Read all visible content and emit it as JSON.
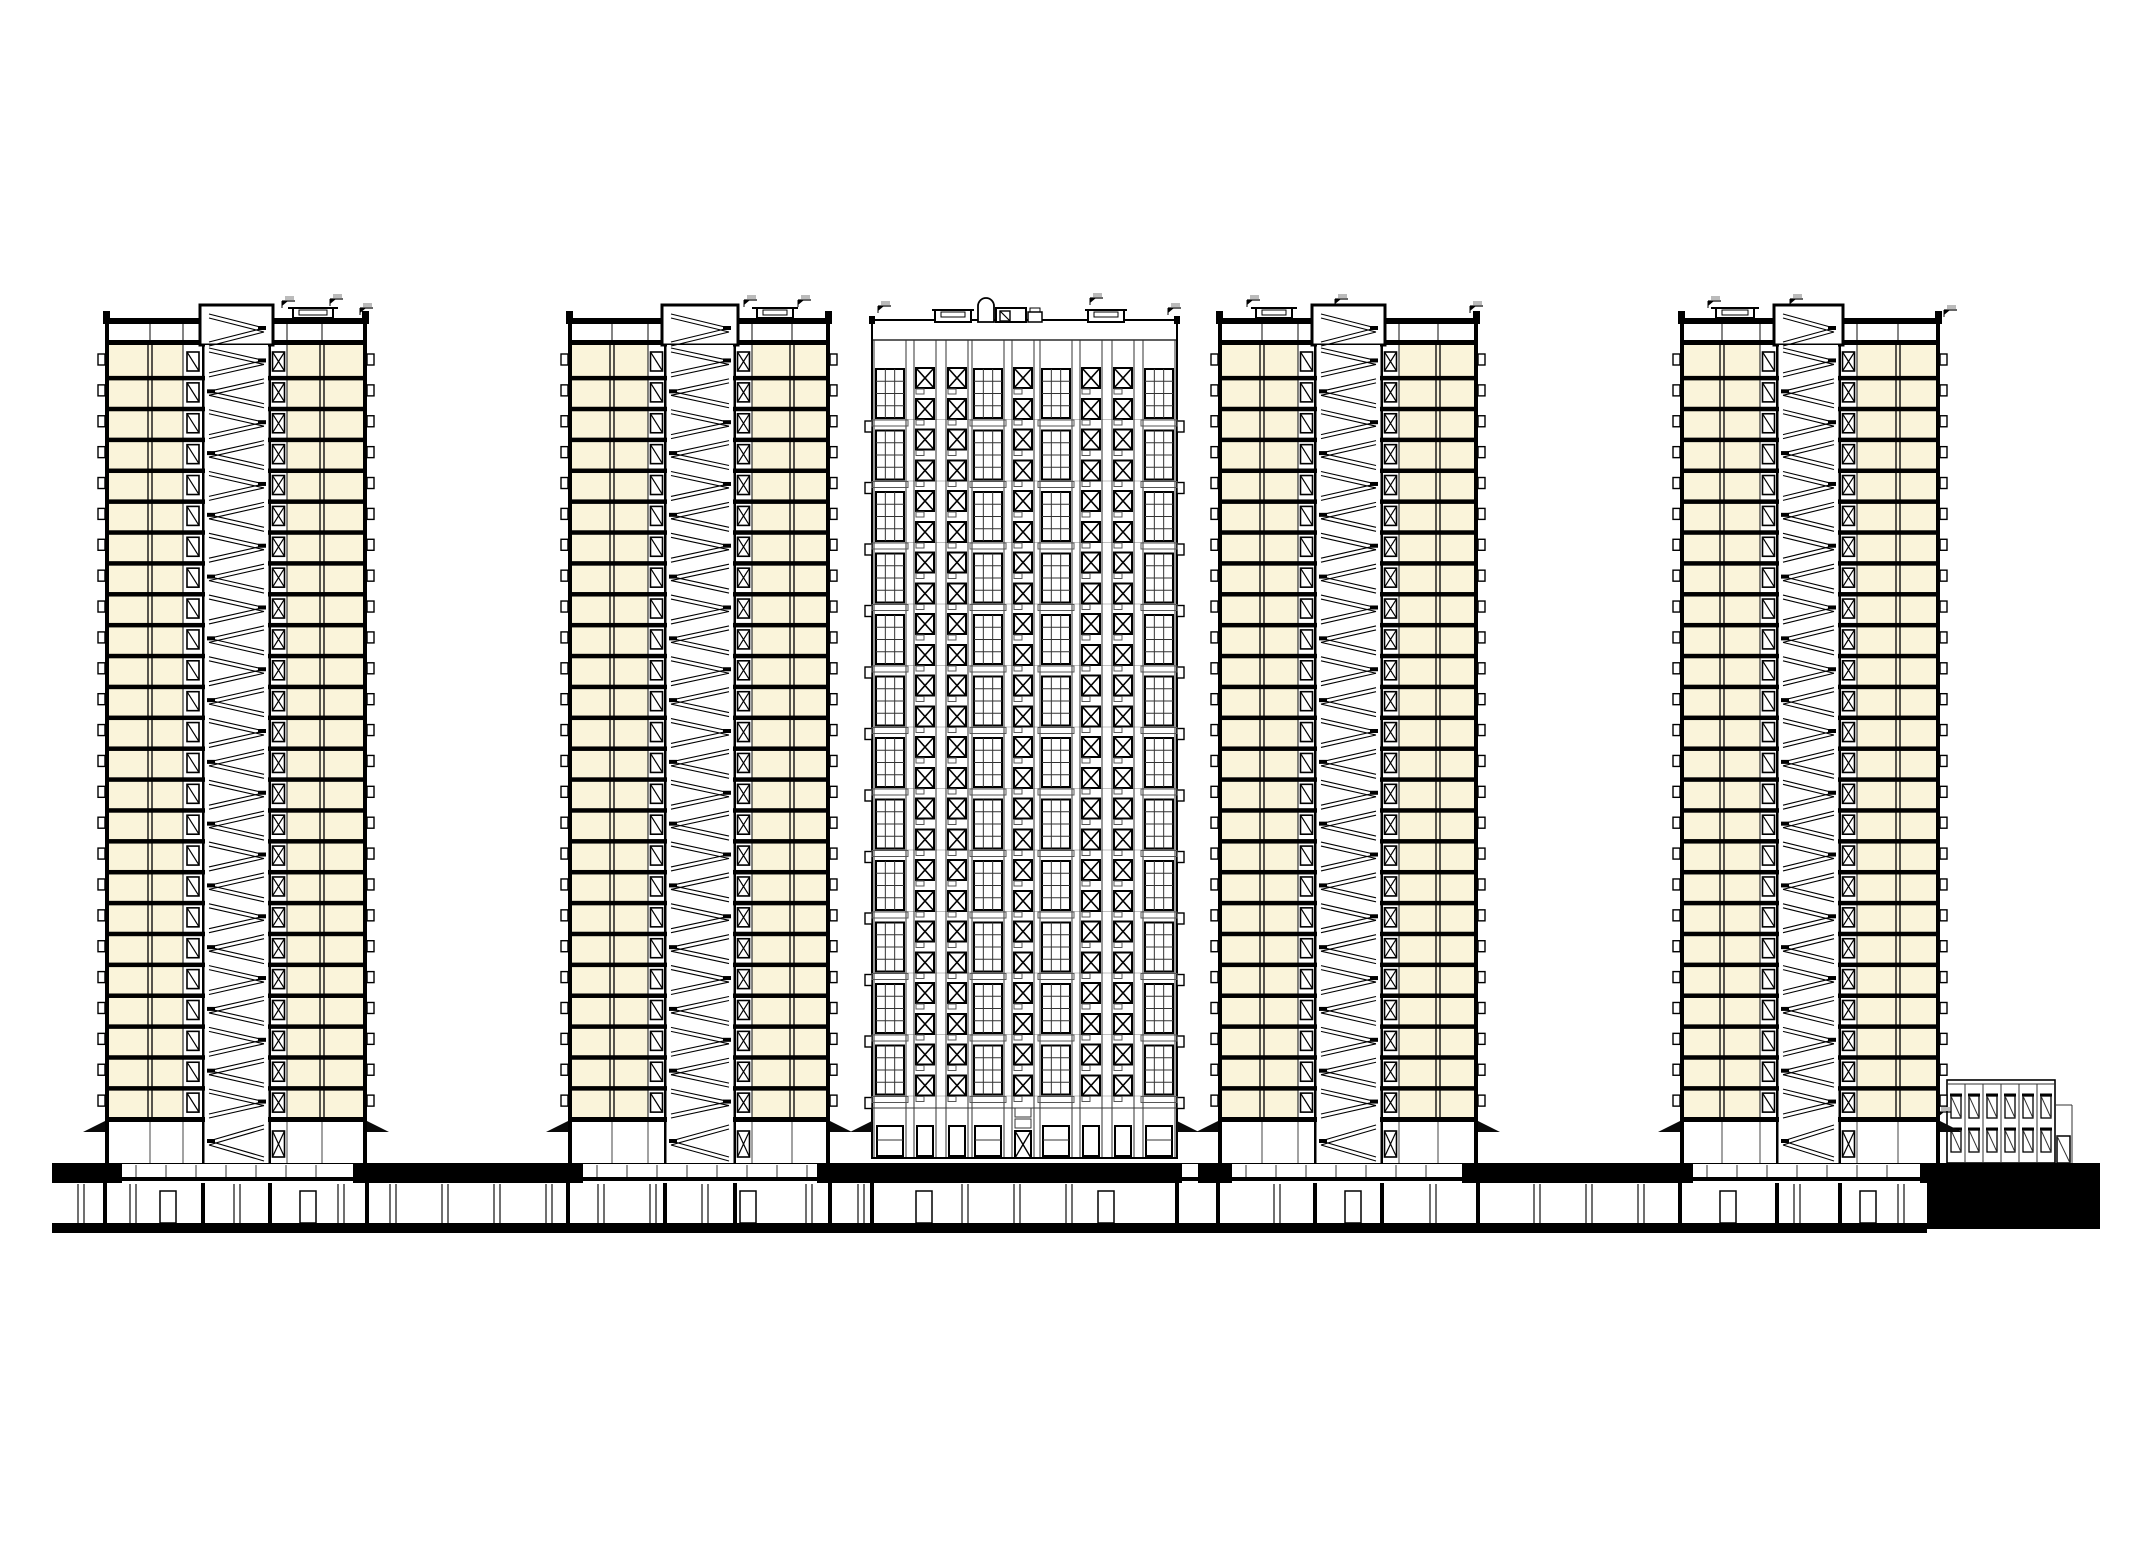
{
  "drawing": {
    "canvas": {
      "w": 2153,
      "h": 1559,
      "bg": "#FFFFFF"
    },
    "palette": {
      "ink": "#000000",
      "thin": "#333333",
      "grey": "#666666",
      "faint": "#AAAAAA",
      "room_fill": "#FAF4DA",
      "white": "#FFFFFF"
    },
    "icons": {
      "canopy": "entrance-canopy-wedge",
      "elevation_marker": "survey-flag",
      "dome": "arched-vent-stack",
      "balcony_tick": "balcony-slab-end"
    },
    "section_common": {
      "parapet_y": 318,
      "parapet_h": 6,
      "attic_top": 324,
      "top_slab_y": 340,
      "top_slab_h": 5,
      "rooms_top": 345,
      "floors": 25,
      "lobby_ceiling_y": 1117,
      "lobby_top": 1122,
      "lobby_bottom": 1163,
      "core_top": 305,
      "wall_w": 4,
      "canopy_len": 22
    },
    "section_towers": [
      {
        "id": "tower-1-section",
        "left": 105,
        "right": 367,
        "core": [
          203,
          270
        ],
        "door_left": [
          183,
          203
        ],
        "door_right": [
          270,
          287
        ],
        "room_left": [
          109,
          183
        ],
        "room_right": [
          287,
          363
        ],
        "partitions": [
          150,
          322
        ],
        "penthouse": {
          "x": 293,
          "w": 40
        },
        "flags": [
          [
            282,
            301
          ],
          [
            330,
            299
          ],
          [
            360,
            308
          ]
        ]
      },
      {
        "id": "tower-2-section",
        "left": 568,
        "right": 830,
        "core": [
          665,
          735
        ],
        "door_left": [
          648,
          665
        ],
        "door_right": [
          735,
          752
        ],
        "room_left": [
          572,
          648
        ],
        "room_right": [
          752,
          826
        ],
        "partitions": [
          612,
          792
        ],
        "penthouse": {
          "x": 757,
          "w": 36
        },
        "flags": [
          [
            744,
            300
          ],
          [
            798,
            300
          ]
        ]
      },
      {
        "id": "tower-4-section",
        "left": 1218,
        "right": 1478,
        "core": [
          1315,
          1382
        ],
        "door_left": [
          1298,
          1315
        ],
        "door_right": [
          1382,
          1399
        ],
        "room_left": [
          1222,
          1298
        ],
        "room_right": [
          1399,
          1474
        ],
        "partitions": [
          1262,
          1438
        ],
        "penthouse": {
          "x": 1256,
          "w": 36
        },
        "flags": [
          [
            1247,
            300
          ],
          [
            1335,
            299
          ],
          [
            1470,
            306
          ]
        ]
      },
      {
        "id": "tower-5-section",
        "left": 1680,
        "right": 1940,
        "core": [
          1777,
          1840
        ],
        "door_left": [
          1760,
          1777
        ],
        "door_right": [
          1840,
          1857
        ],
        "room_left": [
          1684,
          1760
        ],
        "room_right": [
          1857,
          1936
        ],
        "partitions": [
          1722,
          1898
        ],
        "penthouse": {
          "x": 1716,
          "w": 38
        },
        "flags": [
          [
            1708,
            301
          ],
          [
            1790,
            299
          ],
          [
            1944,
            310
          ]
        ]
      }
    ],
    "elevation_tower": {
      "id": "tower-3-elevation",
      "left": 872,
      "right": 1177,
      "parapet_y": 322,
      "strip_top": 340,
      "windows_top": 367,
      "unit_h": 61.5,
      "units": 12,
      "ground_fascia_y": 1108,
      "base_y": 1158,
      "strips": [
        {
          "type": "grid",
          "x": 874,
          "w": 32
        },
        {
          "type": "x",
          "x": 914,
          "w": 22
        },
        {
          "type": "x",
          "x": 946,
          "w": 22
        },
        {
          "type": "grid",
          "x": 972,
          "w": 32
        },
        {
          "type": "x",
          "x": 1012,
          "w": 22
        },
        {
          "type": "grid",
          "x": 1040,
          "w": 32
        },
        {
          "type": "x",
          "x": 1080,
          "w": 22
        },
        {
          "type": "x",
          "x": 1112,
          "w": 22
        },
        {
          "type": "grid",
          "x": 1143,
          "w": 32
        }
      ],
      "center_strip_index": 4,
      "roof_items": [
        {
          "type": "hatch",
          "x": 935,
          "w": 36
        },
        {
          "type": "dome",
          "x": 978,
          "w": 16
        },
        {
          "type": "vent",
          "x": 996,
          "w": 30
        },
        {
          "type": "box",
          "x": 1028,
          "w": 14
        },
        {
          "type": "hatch",
          "x": 1088,
          "w": 36
        }
      ],
      "flags": [
        [
          878,
          306
        ],
        [
          1090,
          298
        ],
        [
          1168,
          308
        ]
      ]
    },
    "ground": {
      "band": {
        "x": 52,
        "y": 1163,
        "w": 2048,
        "h": 20
      },
      "white_segments": [
        [
          122,
          353
        ],
        [
          583,
          817
        ],
        [
          1182,
          1198
        ],
        [
          1232,
          1462
        ],
        [
          1693,
          1920
        ]
      ],
      "basement": {
        "y": 1183,
        "h": 40,
        "x1": 52,
        "x2": 2100,
        "column_step": 52,
        "doors": [
          160,
          300,
          740,
          916,
          1098,
          1345,
          1720,
          1860
        ],
        "walls": [
          105,
          203,
          270,
          367,
          568,
          665,
          735,
          830,
          872,
          1177,
          1218,
          1315,
          1382,
          1478,
          1680,
          1777,
          1840,
          1940,
          2055
        ]
      },
      "bottom_band": {
        "x": 52,
        "y": 1223,
        "w": 1875,
        "h": 10
      },
      "annex_block": {
        "x": 1927,
        "y": 1163,
        "w": 173,
        "h": 66
      }
    },
    "annex": {
      "x": 1947,
      "y": 1080,
      "w": 108,
      "h": 83,
      "bays": 6,
      "window_rows": [
        1094,
        1128
      ],
      "window_h": 24,
      "door": {
        "x": 2057,
        "y": 1136,
        "w": 13,
        "h": 27
      },
      "porch": {
        "x": 2072,
        "top": 1105
      },
      "flag": [
        1938,
        1112
      ]
    }
  }
}
